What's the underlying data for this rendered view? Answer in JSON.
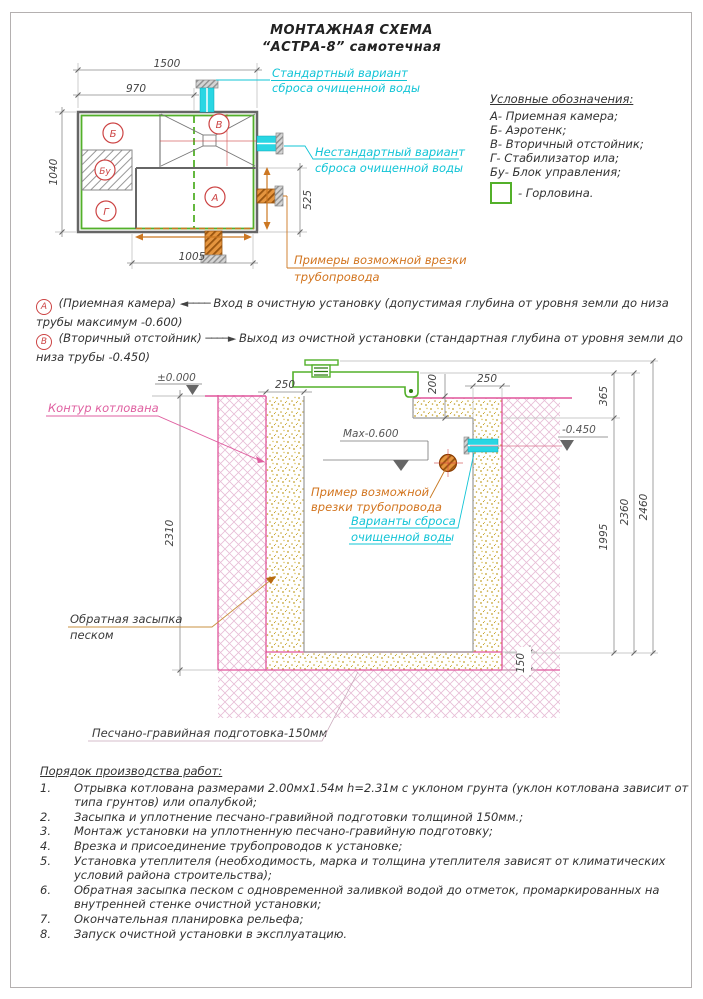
{
  "title": {
    "line1": "МОНТАЖНАЯ СХЕМА",
    "line2": "“АСТРА-8” самотечная"
  },
  "legend": {
    "title": "Условные обозначения:",
    "items": [
      {
        "key": "А-",
        "label": "Приемная камера;"
      },
      {
        "key": "Б-",
        "label": "Аэротенк;"
      },
      {
        "key": "В-",
        "label": "Вторичный отстойник;"
      },
      {
        "key": "Г-",
        "label": "Стабилизатор ила;"
      },
      {
        "key": "Бу-",
        "label": "Блок управления;"
      }
    ],
    "gorlovina": "- Горловина."
  },
  "notes": {
    "a": {
      "letter": "А",
      "pre": "(Приемная камера)",
      "arrow": "◄────",
      "text": "Вход в очистную установку (допустимая глубина от уровня земли до низа трубы максимум -0.600)"
    },
    "b": {
      "letter": "В",
      "pre": "(Вторичный отстойник)",
      "arrow": "────►",
      "text": "Выход из очистной установки (стандартная глубина от уровня земли до низа трубы -0.450)"
    }
  },
  "plan": {
    "compartments": {
      "a": "А",
      "b": "Б",
      "v": "В",
      "g": "Г",
      "bu": "Бу"
    },
    "dims": {
      "d1500": "1500",
      "d970": "970",
      "d1040": "1040",
      "d525": "525",
      "d1005": "1005"
    },
    "labels": {
      "std1": "Стандартный вариант",
      "std2": "сброса очищенной воды",
      "nonstd1": "Нестандартный вариант",
      "nonstd2": "сброса очищенной воды",
      "examples1": "Примеры возможной врезки",
      "examples2": "трубопровода"
    }
  },
  "section": {
    "dims": {
      "d250l": "250",
      "d200": "200",
      "d250r": "250",
      "d365": "365",
      "d2310": "2310",
      "d2360": "2360",
      "d2460": "2460",
      "d1995": "1995",
      "d150": "150"
    },
    "levels": {
      "zero": "±0.000",
      "max": "Max-0.600",
      "out": "-0.450"
    },
    "labels": {
      "kontur": "Контур котлована",
      "zasypka1": "Обратная засыпка",
      "zasypka2": "песком",
      "podgotovka": "Песчано-гравийная подготовка-150мм",
      "primer1": "Пример возможной",
      "primer2": "врезки трубопровода",
      "variants1": "Варианты сброса",
      "variants2": "очищенной воды"
    }
  },
  "worklist": {
    "title": "Порядок производства работ:",
    "items": [
      {
        "n": "1.",
        "t": "Отрывка котлована размерами 2.00мх1.54м h=2.31м с уклоном грунта (уклон котлована зависит от типа грунтов) или опалубкой;"
      },
      {
        "n": "2.",
        "t": "Засыпка и уплотнение песчано-гравийной подготовки толщиной 150мм.;"
      },
      {
        "n": "3.",
        "t": "Монтаж установки на уплотненную песчано-гравийную подготовку;"
      },
      {
        "n": "4.",
        "t": "Врезка и присоединение трубопроводов к установке;"
      },
      {
        "n": "5.",
        "t": "Установка утеплителя (необходимость, марка и толщина утеплителя зависят от климатических условий района строительства);"
      },
      {
        "n": "6.",
        "t": "Обратная засыпка песком с одновременной заливкой водой до отметок, промаркированных на внутренней стенке очистной установки;"
      },
      {
        "n": "7.",
        "t": "Окончательная планировка рельефа;"
      },
      {
        "n": "8.",
        "t": "Запуск очистной установки в эксплуатацию."
      }
    ]
  },
  "colors": {
    "green": "#53b02a",
    "cyan": "#12c4d6",
    "orange": "#d2741e",
    "magenta": "#df5fa0",
    "red": "#cc4444"
  }
}
